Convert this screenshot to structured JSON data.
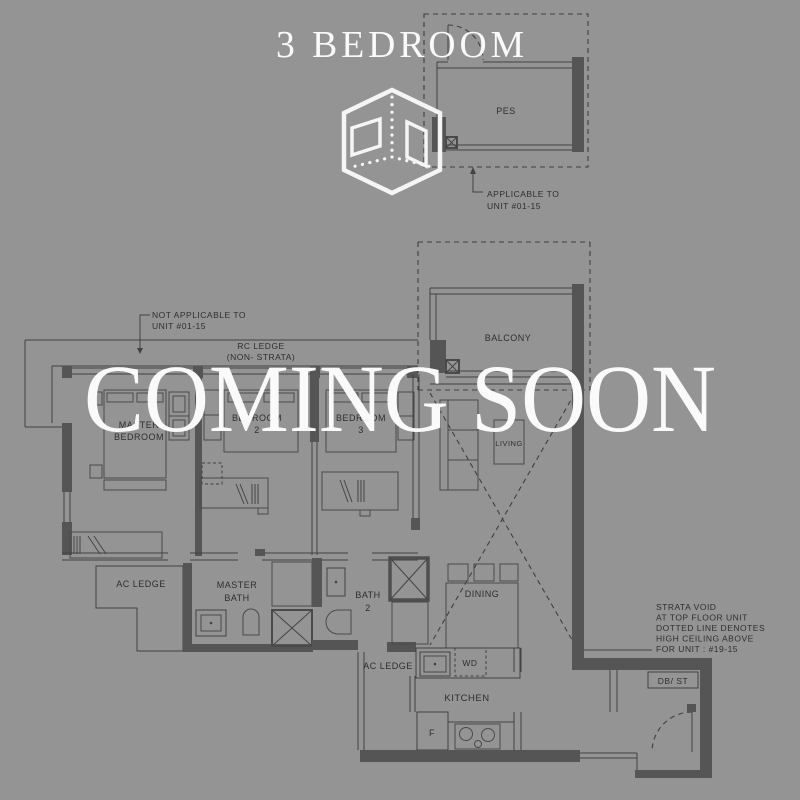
{
  "meta": {
    "background_color": "#949494",
    "plan_line_color": "#424242",
    "wall_fill_color": "#555555",
    "overlay_text_color": "#fafafa",
    "label_color": "#2e2e2e"
  },
  "header": {
    "title": "3 BEDROOM",
    "icon": "isometric-room-cube"
  },
  "overlay": {
    "message": "COMING SOON"
  },
  "pes": {
    "room": "PES",
    "note": [
      "APPLICABLE TO",
      "UNIT #01-15"
    ]
  },
  "plan": {
    "notes": {
      "not_applicable": [
        "NOT APPLICABLE TO",
        "UNIT #01-15"
      ],
      "rc_ledge": [
        "RC LEDGE",
        "(NON- STRATA)"
      ],
      "strata_void": [
        "STRATA VOID",
        "AT TOP FLOOR UNIT",
        "DOTTED LINE DENOTES",
        "HIGH CEILING ABOVE",
        "FOR UNIT : #19-15"
      ]
    },
    "rooms": {
      "balcony": "BALCONY",
      "living": "LIVING",
      "master_bedroom": [
        "MASTER",
        "BEDROOM"
      ],
      "bedroom2": [
        "BEDROOM",
        "2"
      ],
      "bedroom3": [
        "BEDROOM",
        "3"
      ],
      "ac_ledge_left": "AC LEDGE",
      "master_bath": [
        "MASTER",
        "BATH"
      ],
      "bath2": [
        "BATH",
        "2"
      ],
      "dining": "DINING",
      "ac_ledge_kitchen": "AC LEDGE",
      "kitchen": "KITCHEN",
      "washer_dryer": "WD",
      "fridge": "F",
      "db_st": "DB/ ST"
    }
  }
}
